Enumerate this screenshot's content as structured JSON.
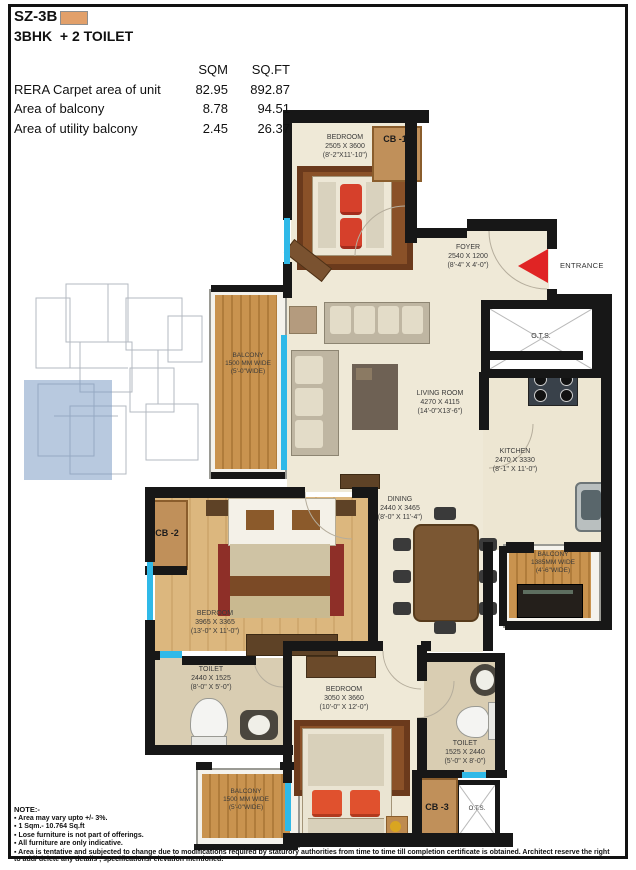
{
  "header": {
    "title": "SZ-3B",
    "subtitle": "3BHK  + 2 TOILET"
  },
  "area_table": {
    "col_sqm": "SQM",
    "col_sqft": "SQ.FT",
    "rows": [
      {
        "label": "RERA Carpet area of unit",
        "sqm": "82.95",
        "sqft": "892.87"
      },
      {
        "label": "Area of balcony",
        "sqm": "8.78",
        "sqft": "94.51"
      },
      {
        "label": "Area of utility balcony",
        "sqm": "2.45",
        "sqft": "26.37"
      }
    ]
  },
  "rooms": {
    "bedroom1": {
      "name": "BEDROOM",
      "mm": "2505 X 3600",
      "ft": "(8'-2\"X11'-10\")"
    },
    "foyer": {
      "name": "FOYER",
      "mm": "2540 X 1200",
      "ft": "(8'-4\" X 4'-0\")"
    },
    "living": {
      "name": "LIVING ROOM",
      "mm": "4270 X 4115",
      "ft": "(14'-0\"X13'-6\")"
    },
    "kitchen": {
      "name": "KITCHEN",
      "mm": "2470 X 3330",
      "ft": "(8'-1\" X 11'-0\")"
    },
    "dining": {
      "name": "DINING",
      "mm": "2440 X 3465",
      "ft": "(8'-0\" X 11'-4\")"
    },
    "bedroom2": {
      "name": "BEDROOM",
      "mm": "3965 X 3365",
      "ft": "(13'-0\" X 11'-0\")"
    },
    "bedroom3": {
      "name": "BEDROOM",
      "mm": "3050 X 3660",
      "ft": "(10'-0\" X 12'-0\")"
    },
    "toilet_left": {
      "name": "TOILET",
      "mm": "2440 X 1525",
      "ft": "(8'-0\" X 5'-0\")"
    },
    "toilet_right": {
      "name": "TOILET",
      "mm": "1525 X 2440",
      "ft": "(5'-0\" X 8'-0\")"
    },
    "balcony_left": {
      "name": "BALCONY",
      "mm": "1500 MM WIDE",
      "ft": "(5'-0\"WIDE)"
    },
    "balcony_right": {
      "name": "BALCONY",
      "mm": "1385MM WIDE",
      "ft": "(4'-6\"WIDE)"
    },
    "balcony_bottom": {
      "name": "BALCONY",
      "mm": "1500 MM WIDE",
      "ft": "(5'-0\"WIDE)"
    }
  },
  "labels": {
    "entrance": "ENTRANCE",
    "ots": "O.T.S.",
    "cb1": "CB -1",
    "cb2": "CB -2",
    "cb3": "CB -3"
  },
  "colors": {
    "legend_swatch": "#E2A06A",
    "wall": "#171717",
    "window": "#2FB9E8",
    "entrance_arrow": "#E02424",
    "balcony_wood": "#C9934F",
    "keyplan_highlight": "#7E9CC4"
  },
  "notes": {
    "heading": "NOTE:-",
    "items": [
      "Area may vary upto +/- 3%.",
      "1 Sqm.- 10.764 Sq.ft",
      "Lose furniture is not part of offerings.",
      "All furniture are only indicative.",
      "Area is tentative and subjected to change due to modifications required by staturory authorities from time to time till completion certificate is obtained. Architect reserve the right to add/ delete any details , specifications/ elevation mentioned."
    ]
  }
}
